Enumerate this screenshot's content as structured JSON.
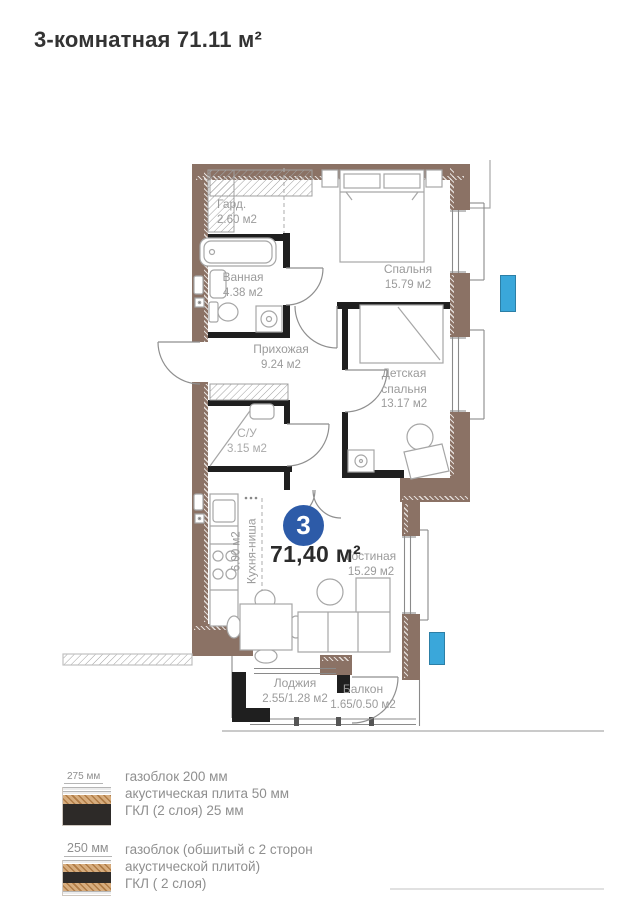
{
  "title": "3-комнатная 71.11 м²",
  "plan": {
    "badge": "3",
    "total_area": "71,40 м²",
    "rooms": [
      {
        "name": "Гард.",
        "area": "2.60 м2"
      },
      {
        "name": "Ванная",
        "area": "4.38 м2"
      },
      {
        "name": "Спальня",
        "area": "15.79 м2"
      },
      {
        "name": "Прихожая",
        "area": "9.24 м2"
      },
      {
        "name": "Детская спальня",
        "area": "13.17 м2"
      },
      {
        "name": "С/У",
        "area": "3.15 м2"
      },
      {
        "name": "Кухня-ниша",
        "area": "6.00 м2"
      },
      {
        "name": "Гостиная",
        "area": "15.29 м2"
      },
      {
        "name": "Лоджия",
        "area": "2.55/1.28 м2"
      },
      {
        "name": "Балкон",
        "area": "1.65/0.50 м2"
      }
    ],
    "colors": {
      "outer_wall": "#8b7265",
      "interior_wall": "#1f1f1f",
      "ac_unit": "#3aa7da",
      "badge": "#2d5ba8",
      "label": "#9b9b9b"
    }
  },
  "legend": {
    "items": [
      {
        "thickness": "275 мм",
        "lines": [
          "газоблок 200 мм",
          "акустическая плита 50 мм",
          "ГКЛ (2 слоя) 25 мм"
        ]
      },
      {
        "thickness": "250 мм",
        "lines": [
          "газоблок (обшитый с 2 сторон",
          "акустической плитой)",
          "ГКЛ ( 2 слоя)"
        ]
      }
    ]
  }
}
